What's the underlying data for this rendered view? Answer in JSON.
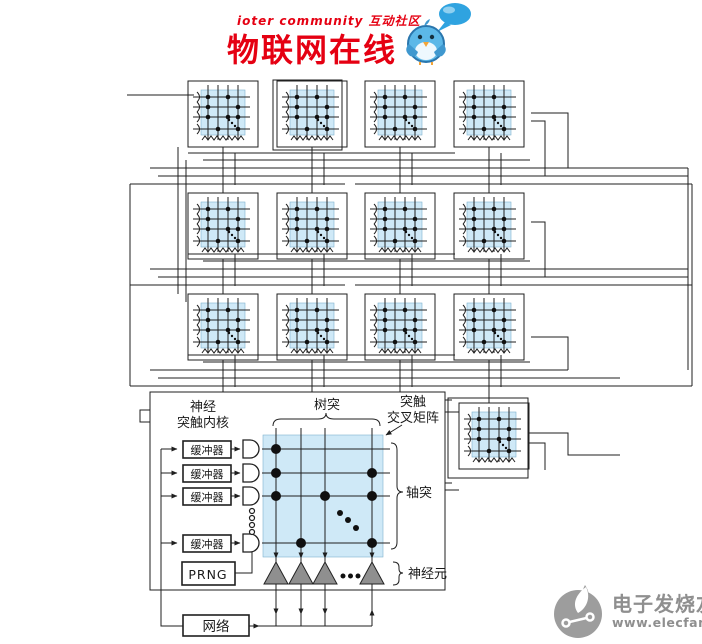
{
  "header": {
    "brand_line": "ioter community 互动社区",
    "title": "物联网在线"
  },
  "diagram": {
    "detail": {
      "core_title_line1": "神经",
      "core_title_line2": "突触内核",
      "dendrite": "树突",
      "crossbar_line1": "突触",
      "crossbar_line2": "交叉矩阵",
      "axon": "轴突",
      "neuron": "神经元",
      "buffer": "缓冲器",
      "prng": "PRNG",
      "network": "网络"
    },
    "core_grid": {
      "rows": 3,
      "columns": 4,
      "extra_core": 1,
      "total_cores": 13
    }
  },
  "watermark": {
    "name": "电子发烧友",
    "url": "www.elecfans.com"
  },
  "colors": {
    "accent_red": "#e50012",
    "crossbar_fill": "#cfe9f7",
    "wire": "#1f1f1f",
    "neuron_fill": "#8f8f8f",
    "bird_blue": "#5cb8e8",
    "watermark_gray": "#9d9d9d"
  }
}
